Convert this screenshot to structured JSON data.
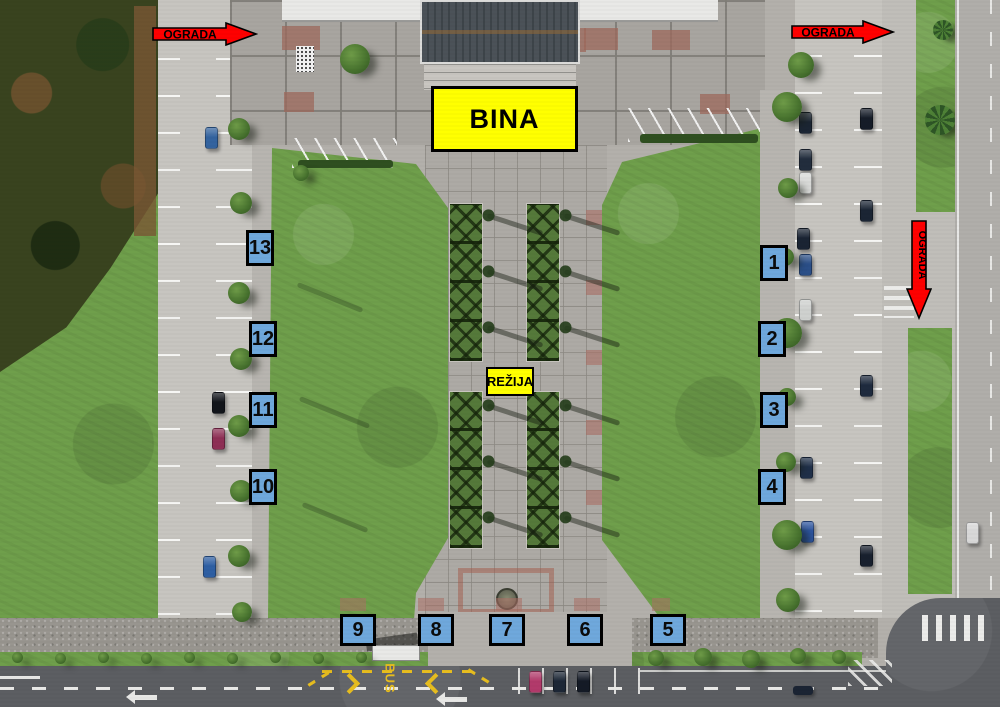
{
  "site_plan": {
    "stage": {
      "label": "BINA"
    },
    "control": {
      "label": "REŽIJA"
    },
    "fences": [
      {
        "label": "OGRADA",
        "direction": "right"
      },
      {
        "label": "OGRADA",
        "direction": "right"
      },
      {
        "label": "OGRADA",
        "direction": "down"
      }
    ],
    "stands": {
      "left": [
        "13",
        "12",
        "11",
        "10"
      ],
      "right": [
        "1",
        "2",
        "3",
        "4"
      ],
      "bottom": [
        "9",
        "8",
        "7",
        "6",
        "5"
      ]
    },
    "road_markings": {
      "bus": "BUS"
    },
    "colors": {
      "stand_fill": "#6fa8dc",
      "stand_border": "#000000",
      "stage_fill": "#ffff00",
      "stage_border": "#000000",
      "arrow_fill": "#ff0000",
      "bus_yellow": "#e7bd1f"
    }
  }
}
